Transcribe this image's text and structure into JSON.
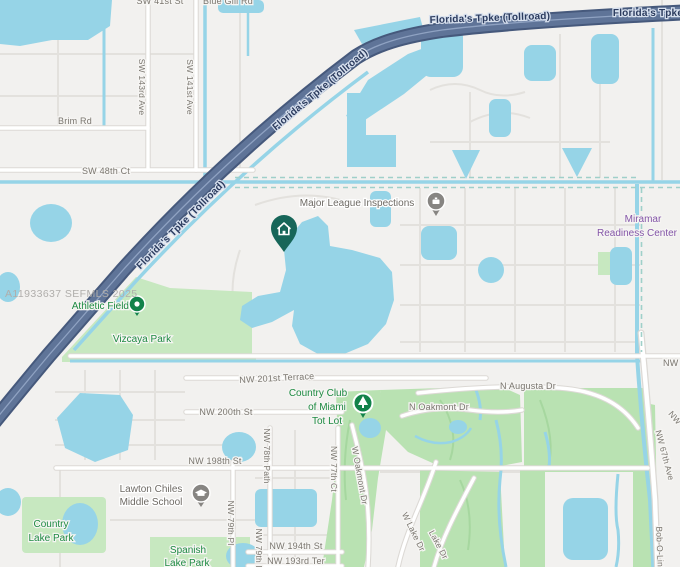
{
  "map": {
    "watermark": "A11933637 SEFMLS 2025",
    "highway": {
      "label_full": "Florida's Tpke (Tollroad)",
      "label_short": "Florida's Tpke"
    },
    "streets": {
      "sw_41st_st": "SW 41st St",
      "blue_gill_rd": "Blue Gill Rd",
      "sw_143rd_ave": "SW 143rd Ave",
      "sw_141st_ave": "SW 141st Ave",
      "brim_rd": "Brim Rd",
      "sw_48th_ct": "SW 48th Ct",
      "nw_201st_terrace": "NW 201st Terrace",
      "nw_200th_st": "NW 200th St",
      "nw_198th_st": "NW 198th St",
      "nw_194th_st": "NW 194th St",
      "nw_193rd_ter": "NW 193rd Ter",
      "nw_79th_pl": "NW 79th Pl",
      "nw_78th_path": "NW 78th Path",
      "nw_77th_ct": "NW 77th Ct",
      "w_oakmont_dr": "W Oakmont Dr",
      "n_oakmont_dr": "N Oakmont Dr",
      "n_augusta_dr": "N Augusta Dr",
      "w_lake_dr": "W Lake Dr",
      "lake_dr": "Lake Dr",
      "nw_67th_ave": "NW 67th Ave",
      "bob_o_link": "Bob-O-Link",
      "nw_partial": "NW"
    },
    "pois": {
      "major_league_inspections": "Major League Inspections",
      "miramar_line1": "Miramar",
      "miramar_line2": "Readiness Center",
      "athletic_field": "Athletic Field",
      "vizcaya_park": "Vizcaya Park",
      "tot_lot_line1": "Country Club",
      "tot_lot_line2": "of Miami",
      "tot_lot_line3": "Tot Lot",
      "lawton_line1": "Lawton Chiles",
      "lawton_line2": "Middle School",
      "country_lake_line1": "Country",
      "country_lake_line2": "Lake Park",
      "spanish_lake_line1": "Spanish",
      "spanish_lake_line2": "Lake Park"
    },
    "marker": {
      "type": "home",
      "color": "#176659"
    },
    "colors": {
      "background": "#f2f1ef",
      "water": "#96d4e7",
      "park": "#c7e8c0",
      "golf": "#b9e2b2",
      "highway_fill": "#5f7498",
      "highway_casing": "#46597c",
      "boundary_dash": "#9fd0c9",
      "road": "#ffffff",
      "road_casing": "#dcd9d5"
    }
  }
}
